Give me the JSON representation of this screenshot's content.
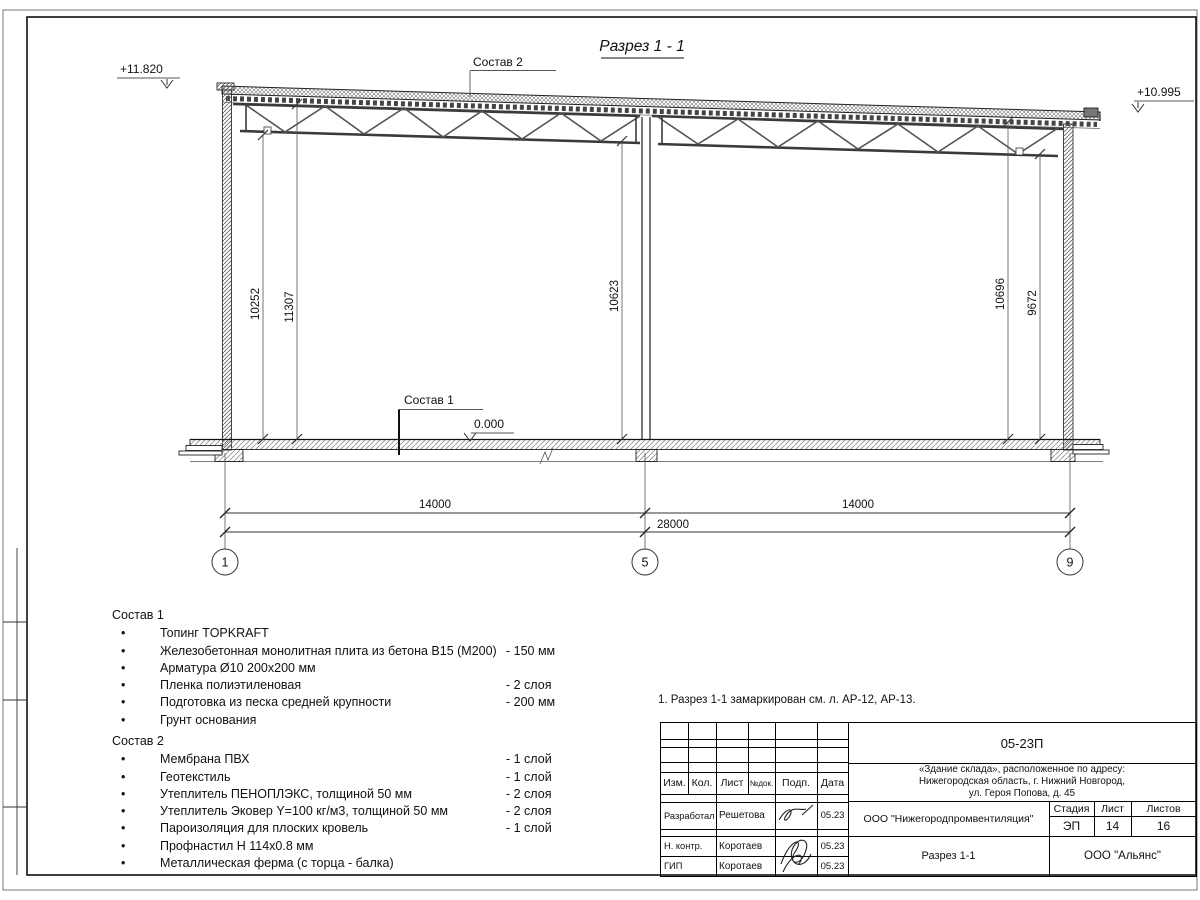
{
  "page": {
    "title": "Разрез 1 - 1",
    "note": "1. Разрез 1-1 замаркирован см. л. АР-12, АР-13."
  },
  "marks": {
    "elev_left": "+11.820",
    "elev_right": "+10.995",
    "elev_floor": "0.000",
    "callout_roof": "Состав 2",
    "callout_floor": "Состав 1"
  },
  "dims": {
    "v1": "10252",
    "v2": "11307",
    "v3": "10623",
    "v4": "10696",
    "v5": "9672",
    "span1": "14000",
    "span2": "14000",
    "total": "28000",
    "axis1": "1",
    "axis2": "5",
    "axis3": "9"
  },
  "sostav1": {
    "heading": "Состав 1",
    "items": [
      {
        "text": "Топинг TOPKRAFT",
        "value": ""
      },
      {
        "text": "Железобетонная монолитная плита из бетона В15 (М200)",
        "value": "-  150 мм"
      },
      {
        "text": "Арматура Ø10 200х200 мм",
        "value": ""
      },
      {
        "text": "Пленка полиэтиленовая",
        "value": "-  2 слоя"
      },
      {
        "text": "Подготовка из песка средней крупности",
        "value": "- 200 мм"
      },
      {
        "text": "Грунт основания",
        "value": ""
      }
    ]
  },
  "sostav2": {
    "heading": "Состав 2",
    "items": [
      {
        "text": "Мембрана ПВХ",
        "value": "- 1 слой"
      },
      {
        "text": "Геотекстиль",
        "value": "- 1 слой"
      },
      {
        "text": "Утеплитель ПЕНОПЛЭКС, толщиной 50 мм",
        "value": "- 2 слоя"
      },
      {
        "text": "Утеплитель Эковер Y=100 кг/м3, толщиной 50 мм",
        "value": "- 2 слоя"
      },
      {
        "text": "Пароизоляция для плоских кровель",
        "value": "- 1 слой"
      },
      {
        "text": "Профнастил Н 114х0.8 мм",
        "value": ""
      },
      {
        "text": "Металлическая ферма (с торца - балка)",
        "value": ""
      }
    ]
  },
  "titleblock": {
    "doc_number": "05-23П",
    "object_line1": "«Здание склада», расположенное по адресу:",
    "object_line2": "Нижегородская область, г. Нижний Новгород,",
    "object_line3": "ул. Героя Попова, д. 45",
    "col_izm": "Изм.",
    "col_kol": "Кол.",
    "col_list": "Лист",
    "col_dok": "№док.",
    "col_podp": "Подп.",
    "col_data": "Дата",
    "row1_role": "Разработал",
    "row1_name": "Решетова",
    "row1_date": "05.23",
    "row2_role": "Н. контр.",
    "row2_name": "Коротаев",
    "row2_date": "05.23",
    "row3_role": "ГИП",
    "row3_name": "Коротаев",
    "row3_date": "05.23",
    "org": "ООО \"Нижегородпромвентиляция\"",
    "stage_label": "Стадия",
    "sheet_label": "Лист",
    "sheets_label": "Листов",
    "stage": "ЭП",
    "sheet": "14",
    "sheets": "16",
    "drawing_name": "Разрез 1-1",
    "company": "ООО \"Альянс\""
  }
}
